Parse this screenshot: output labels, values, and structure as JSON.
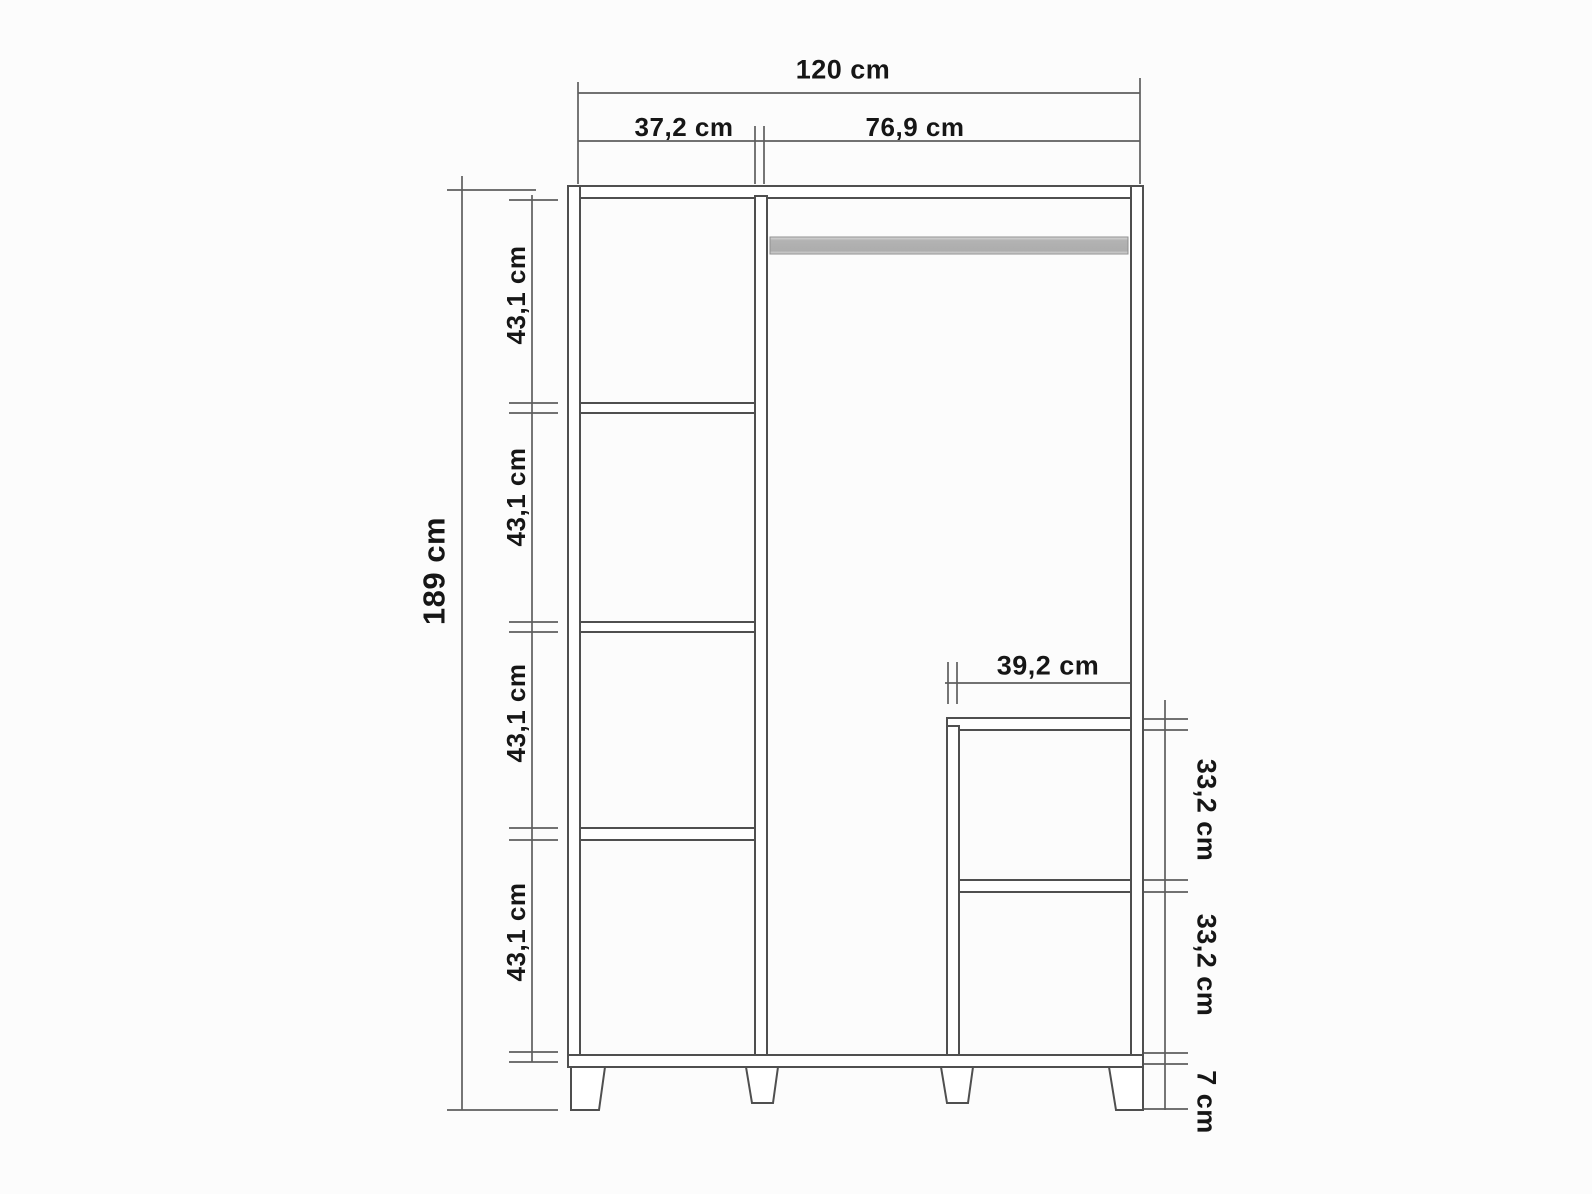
{
  "colors": {
    "background": "#fcfcfc",
    "furniture_line": "#4f4f4f",
    "dimension_line": "#5e5e5e",
    "label_text": "#161616",
    "rail_gray": "#b3b3b3"
  },
  "wardrobe": {
    "overall": {
      "width_label": "120 cm",
      "height_label": "189 cm"
    },
    "sections": {
      "left_width_label": "37,2 cm",
      "right_width_label": "76,9 cm"
    },
    "left_column_gaps": [
      "43,1 cm",
      "43,1 cm",
      "43,1 cm",
      "43,1 cm"
    ],
    "inner_unit": {
      "width_label": "39,2 cm",
      "gap_labels": [
        "33,2 cm",
        "33,2 cm"
      ]
    },
    "feet_height_label": "7 cm"
  }
}
